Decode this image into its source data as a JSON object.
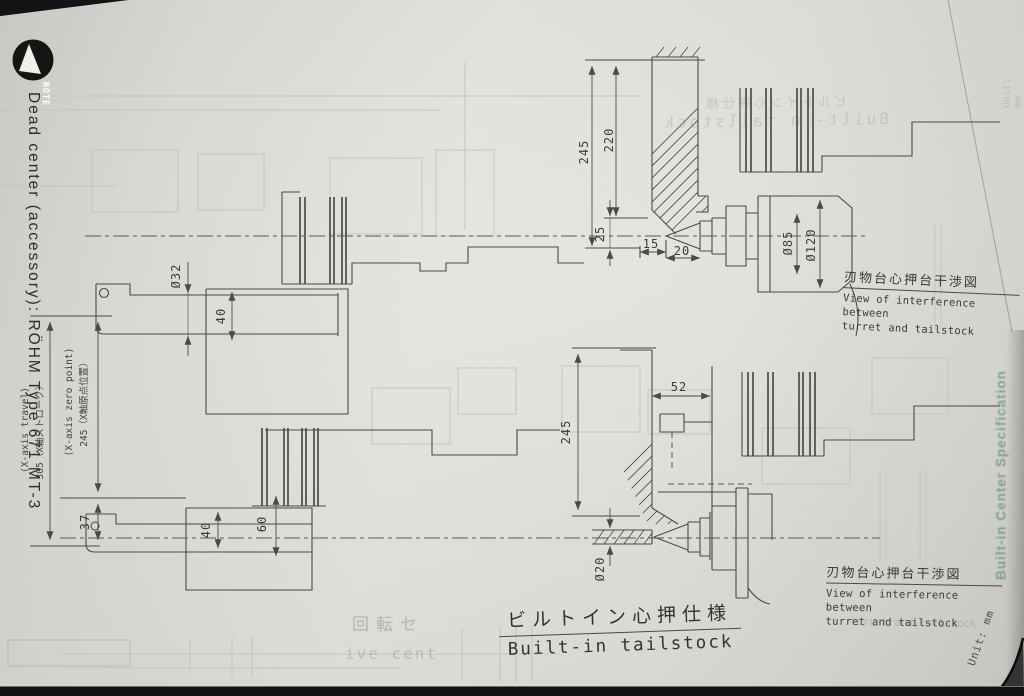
{
  "note_badge": {
    "label": "NOTE"
  },
  "side_label": {
    "text": "Dead center (accessory): RÖHM Type 671 MT-3"
  },
  "upper_view": {
    "caption_jp": "刃物台心押台干渉図",
    "caption_en1": "View of interference between",
    "caption_en2": "turret and tailstock",
    "dims": {
      "overall": "245",
      "turret_face": "220",
      "offset": "25",
      "tip_len": "15",
      "cone_len": "20",
      "dia85": "Ø85",
      "dia120": "Ø120",
      "quill_dia": "Ø32",
      "body_h": "40"
    }
  },
  "lower_view": {
    "caption_jp": "刃物台心押台干渉図",
    "caption_en1": "View of interference between",
    "caption_en2": "turret and tailstock",
    "dims": {
      "overall": "245",
      "clearance": "52",
      "bar_dia": "Ø20",
      "body_h": "40",
      "height": "60"
    }
  },
  "axis": {
    "travel_en": "(X-axis travel)",
    "travel_jp": "305（X軸ストローク）",
    "zero_en": "(X-axis zero point)",
    "zero_jp": "245（X軸原点位置）",
    "offset": "37"
  },
  "title": {
    "jp": "ビルトイン心押仕様",
    "en": "Built-in tailstock"
  },
  "corner_note": {
    "text": "Unit: mm"
  },
  "ghosts": {
    "tab": "Built-in Center Specification",
    "title_jp": "ビルトイン心押仕様",
    "title_en": "Built-in tailstock",
    "unit": "Unit: mm",
    "bottom_jp": "回転セ",
    "bottom_en": "ive cent",
    "caption_echo": "turret and tailstock"
  },
  "colors": {
    "paper": "#e0ded9",
    "ink": "#4b4a45",
    "ghost_green": "#5f8f7a",
    "background": "#141416"
  }
}
